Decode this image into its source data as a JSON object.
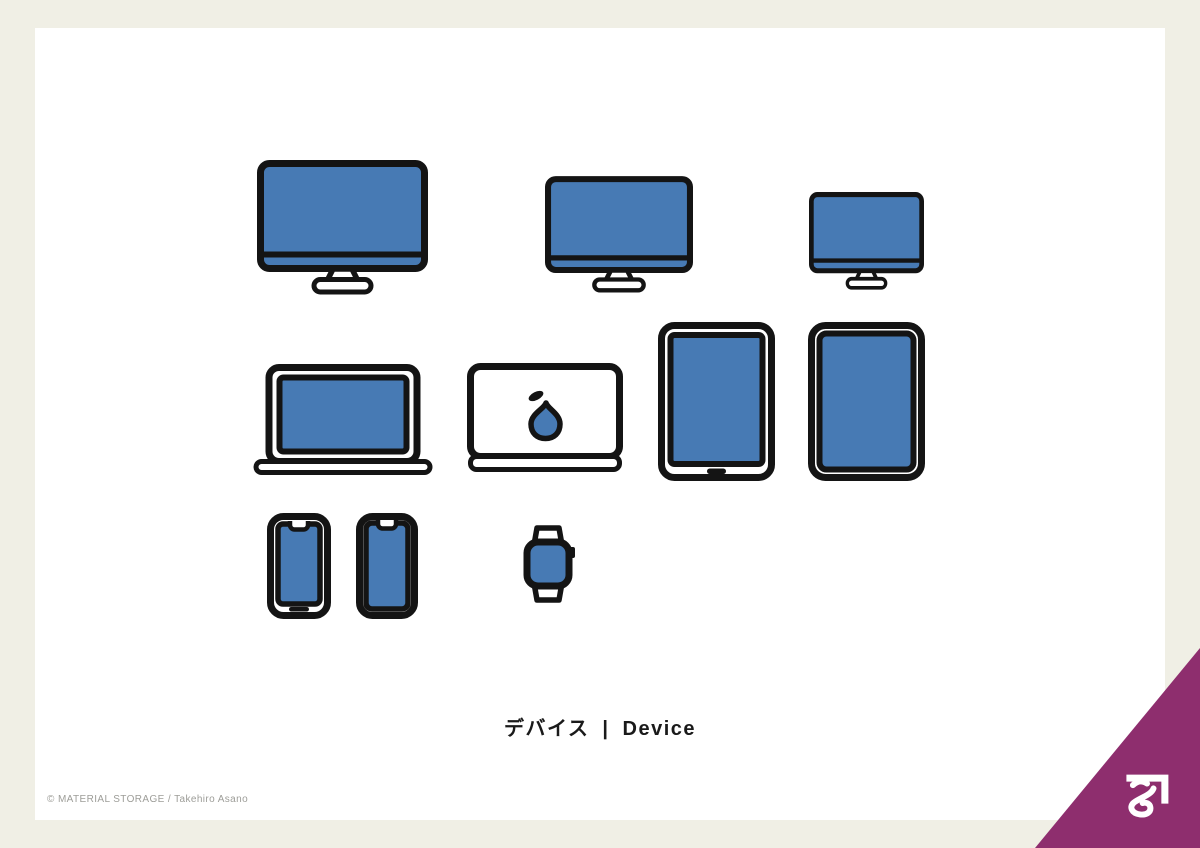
{
  "title": {
    "ja": "デバイス",
    "divider": "|",
    "en": "Device"
  },
  "credit": "© MATERIAL STORAGE / Takehiro Asano",
  "colors": {
    "background": "#F0EFE5",
    "card": "#FFFFFF",
    "device_fill": "#477AB4",
    "outline": "#141414",
    "accent_corner": "#8E2E6E",
    "logo_white": "#FFFFFF",
    "title_text": "#1A1A1A",
    "credit_text": "#9D9D98"
  },
  "devices": [
    {
      "label": "Desktop monitor large"
    },
    {
      "label": "Desktop monitor medium"
    },
    {
      "label": "Desktop monitor small"
    },
    {
      "label": "Laptop open"
    },
    {
      "label": "Laptop closed with pear logo"
    },
    {
      "label": "Tablet with home button"
    },
    {
      "label": "Tablet bezel-less"
    },
    {
      "label": "Smartphone with home indicator"
    },
    {
      "label": "Smartphone bezel-less"
    },
    {
      "label": "Smartwatch"
    }
  ]
}
